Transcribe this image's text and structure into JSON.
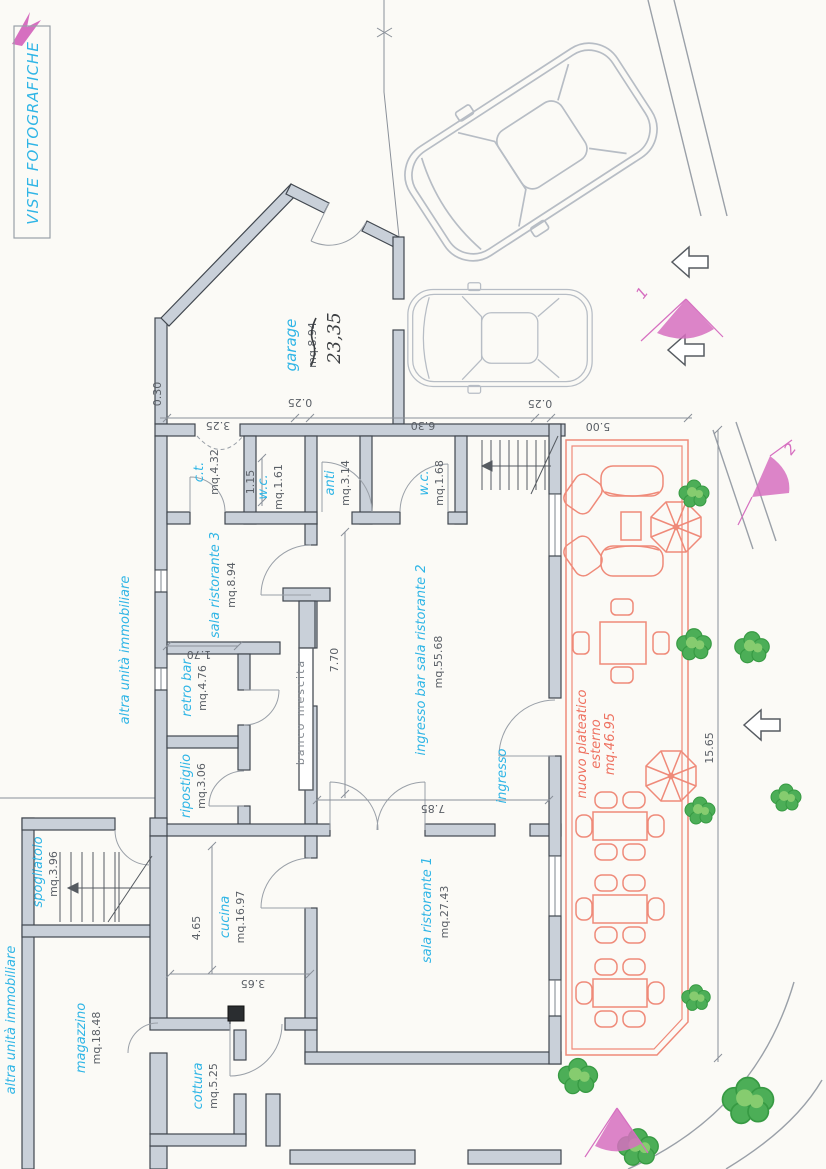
{
  "header": {
    "photo_views_label": "VISTE FOTOGRAFICHE"
  },
  "rooms": {
    "garage": {
      "name": "garage",
      "area_old": "mq.8.94",
      "area_hand": "23,35"
    },
    "ct": {
      "name": "c.t.",
      "area": "mq.4.32"
    },
    "wc1": {
      "name": "w.c.",
      "area": "mq.1.61"
    },
    "anti": {
      "name": "anti",
      "area": "mq.3.14"
    },
    "wc2": {
      "name": "w.c.",
      "area": "mq.1.68"
    },
    "sala3": {
      "name": "sala ristorante 3",
      "area": "mq.8.94"
    },
    "retro": {
      "name": "retro bar",
      "area": "mq.4.76"
    },
    "ripostiglio": {
      "name": "ripostiglio",
      "area": "mq.3.06"
    },
    "hall": {
      "name": "ingresso bar sala ristorante 2",
      "area": "mq.55.68"
    },
    "sala1": {
      "name": "sala ristorante 1",
      "area": "mq.27.43"
    },
    "cucina": {
      "name": "cucina",
      "area": "mq.16.97"
    },
    "spogliatoio": {
      "name": "spogliatoio",
      "area": "mq.3.96"
    },
    "magazzino": {
      "name": "magazzino",
      "area": "mq.18.48"
    },
    "cottura": {
      "name": "cottura",
      "area": "mq.5.25"
    },
    "ingresso": {
      "name": "ingresso"
    },
    "banco": {
      "name": "banco  mescita"
    }
  },
  "outdoor": {
    "line1": "nuovo plateatico",
    "line2": "esterno",
    "area": "mq.46.95"
  },
  "adjacent": {
    "upper": "altra unità immobiliare",
    "lower": "altra unità immobiliare"
  },
  "dimensions": {
    "top_ct": "3.25",
    "top_wall_a": "0.25",
    "top_hall": "6.30",
    "top_wall_b": "0.25",
    "top_plateatico": "5.00",
    "side_030": "0.30",
    "wc_width": "1.15",
    "retro_width": "1.70",
    "hall_height": "7.70",
    "hall_width": "7.85",
    "cucina_height": "4.65",
    "cucina_width": "3.65",
    "plateatico_height": "15.65"
  },
  "view_markers": {
    "m1": "1",
    "m2": "2"
  }
}
